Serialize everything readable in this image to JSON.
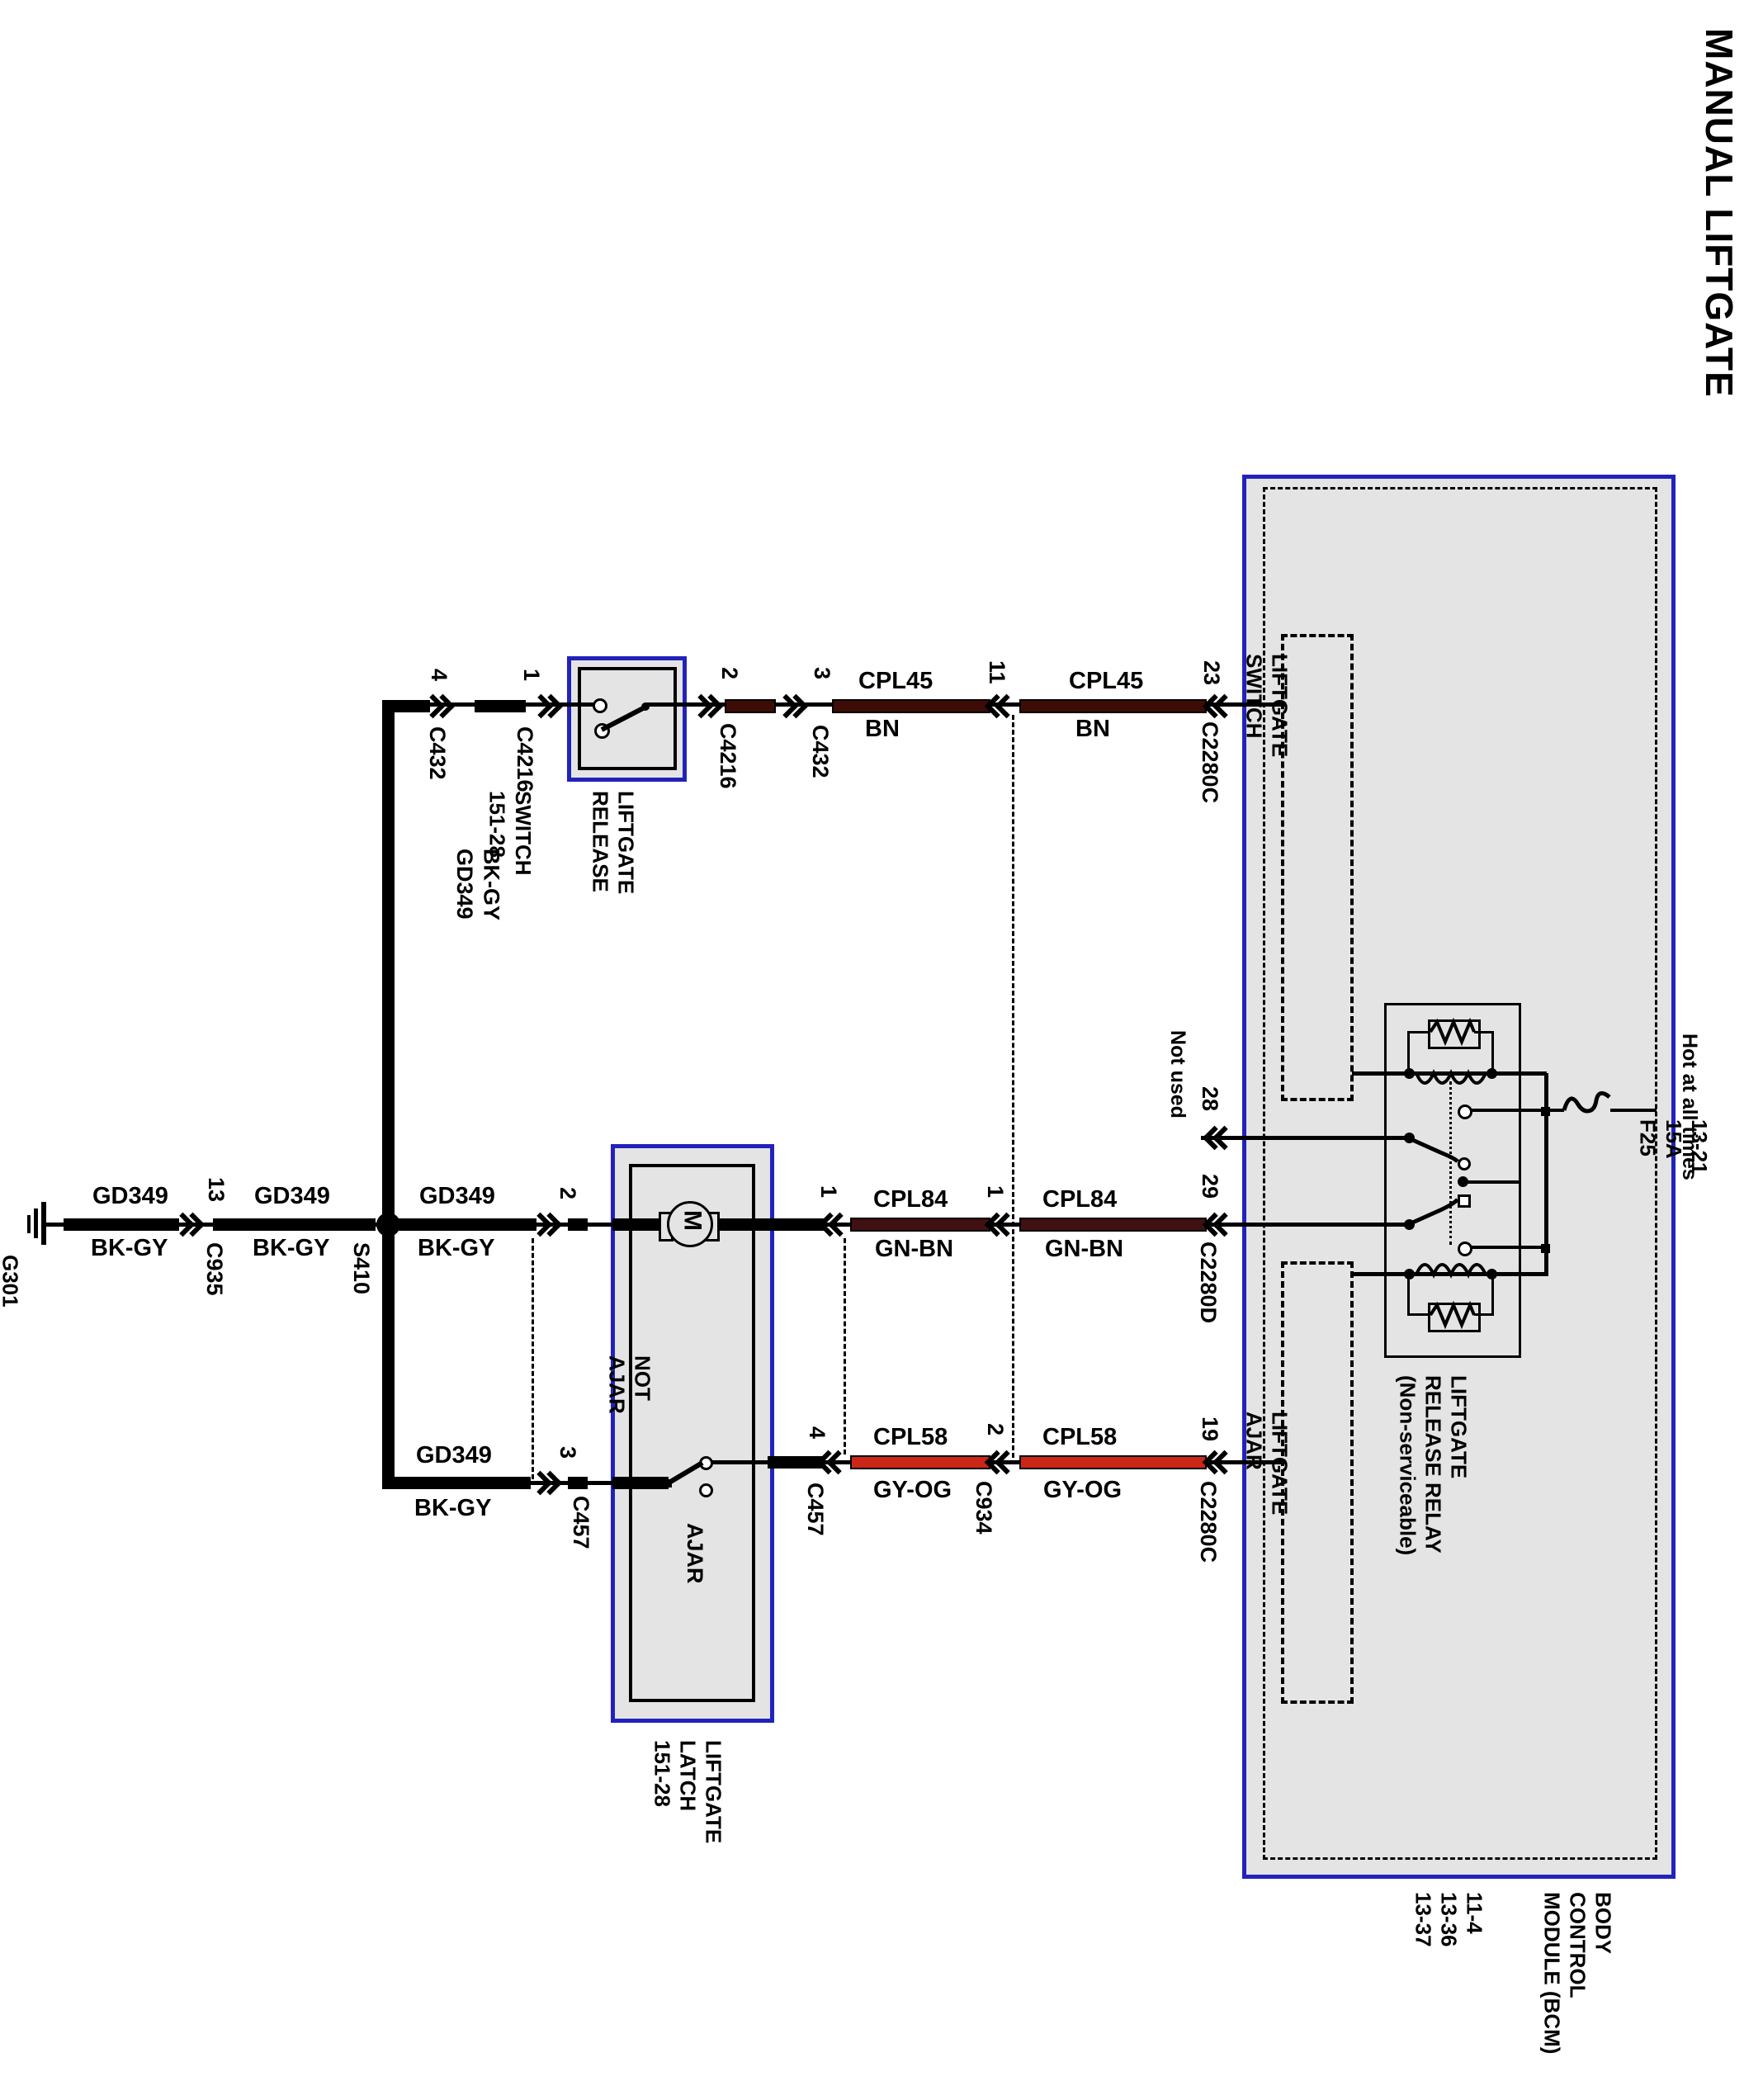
{
  "title": "MANUAL LIFTGATE",
  "colors": {
    "blue": "#2222bb",
    "panel_gray": "#e4e4e4",
    "bn": "#3d0c06",
    "gn_bn": "#401012",
    "gy_og": "#cc2618"
  },
  "power": {
    "feed": "Hot at all times",
    "fuse_lines": [
      "F25",
      "15A",
      "13-21"
    ]
  },
  "ground_node": {
    "lines": [
      "G301",
      "10-12"
    ],
    "splice": "S410",
    "not_used": "Not used"
  },
  "circuits": {
    "gd349": {
      "name": "GD349",
      "color": "BK-GY"
    },
    "cpl45": {
      "name": "CPL45",
      "color": "BN"
    },
    "cpl84": {
      "name": "CPL84",
      "color": "GN-BN"
    },
    "cpl58": {
      "name": "CPL58",
      "color": "GY-OG"
    }
  },
  "connectors": {
    "c432": "C432",
    "c4216": "C4216",
    "c935": "C935",
    "c457": "C457",
    "c934": "C934",
    "c2280c": "C2280C",
    "c2280d": "C2280D"
  },
  "pins": {
    "switch_gnd": "4",
    "switch_in": "1",
    "switch_out": "2",
    "switch_out2": "3",
    "release_c934": "11",
    "release_bcm": "23",
    "ground_c935": "13",
    "motor_gnd": "2",
    "motor_out": "1",
    "motor_c934": "1",
    "motor_bcm": "29",
    "relay_not_used": "28",
    "ajar_gnd": "3",
    "ajar_out": "4",
    "ajar_c934": "2",
    "ajar_bcm": "19"
  },
  "components": {
    "release_switch": {
      "lines": [
        "LIFTGATE",
        "RELEASE",
        "SWITCH",
        "151-28"
      ]
    },
    "latch": {
      "lines": [
        "LIFTGATE",
        "LATCH",
        "151-28"
      ],
      "motor": "M",
      "pos_closed": [
        "NOT",
        "AJAR"
      ],
      "pos_open": "AJAR"
    },
    "bcm": {
      "lines": [
        "BODY",
        "CONTROL",
        "MODULE (BCM)",
        "11-4",
        "13-36",
        "13-37"
      ],
      "switch_block": [
        "LIFTGATE",
        "SWITCH"
      ],
      "ajar_block": [
        "LIFTGATE",
        "AJAR"
      ],
      "relay": [
        "LIFTGATE",
        "RELEASE RELAY",
        "(Non-serviceable)"
      ]
    }
  }
}
